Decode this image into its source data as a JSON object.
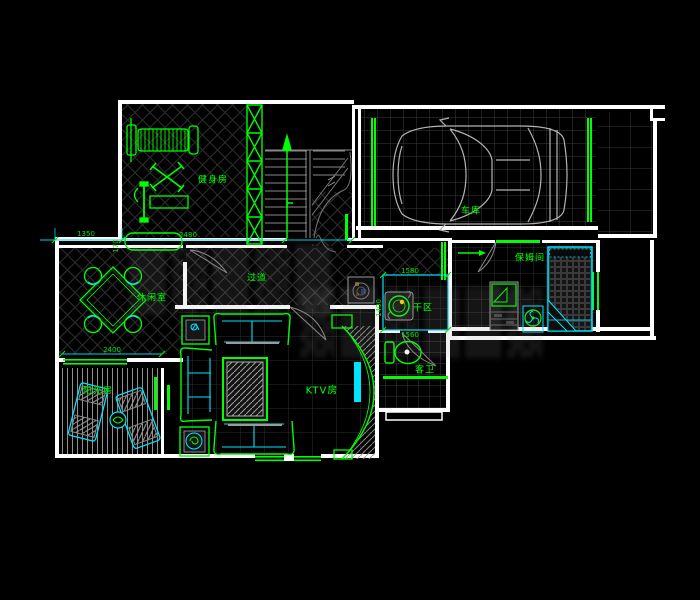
{
  "title": "residential floor plan (CAD drawing)",
  "colors": {
    "background": "#000000",
    "wall": "#ffffff",
    "line_green": "#00ff00",
    "accent_cyan": "#00e5ff",
    "dim_cyan": "#00ffff",
    "grid_gray": "#3c3c3c"
  },
  "rooms": {
    "gym": {
      "label": "健身房"
    },
    "garage": {
      "label": "车库"
    },
    "hallway": {
      "label": "过道"
    },
    "leisure": {
      "label": "休闲室"
    },
    "sunroom": {
      "label": "阳光房"
    },
    "ktv": {
      "label": "KTV房"
    },
    "dry": {
      "label": "干区"
    },
    "bath": {
      "label": "客卫"
    },
    "nanny": {
      "label": "保姆间"
    }
  },
  "dims": {
    "d1350": {
      "v": "1350"
    },
    "d170": {
      "v": "170"
    },
    "d2480": {
      "v": "2480"
    },
    "d2400": {
      "v": "2400"
    },
    "d1580": {
      "v": "1580"
    },
    "d1400": {
      "v": "1400"
    },
    "d1560": {
      "v": "1560"
    }
  }
}
